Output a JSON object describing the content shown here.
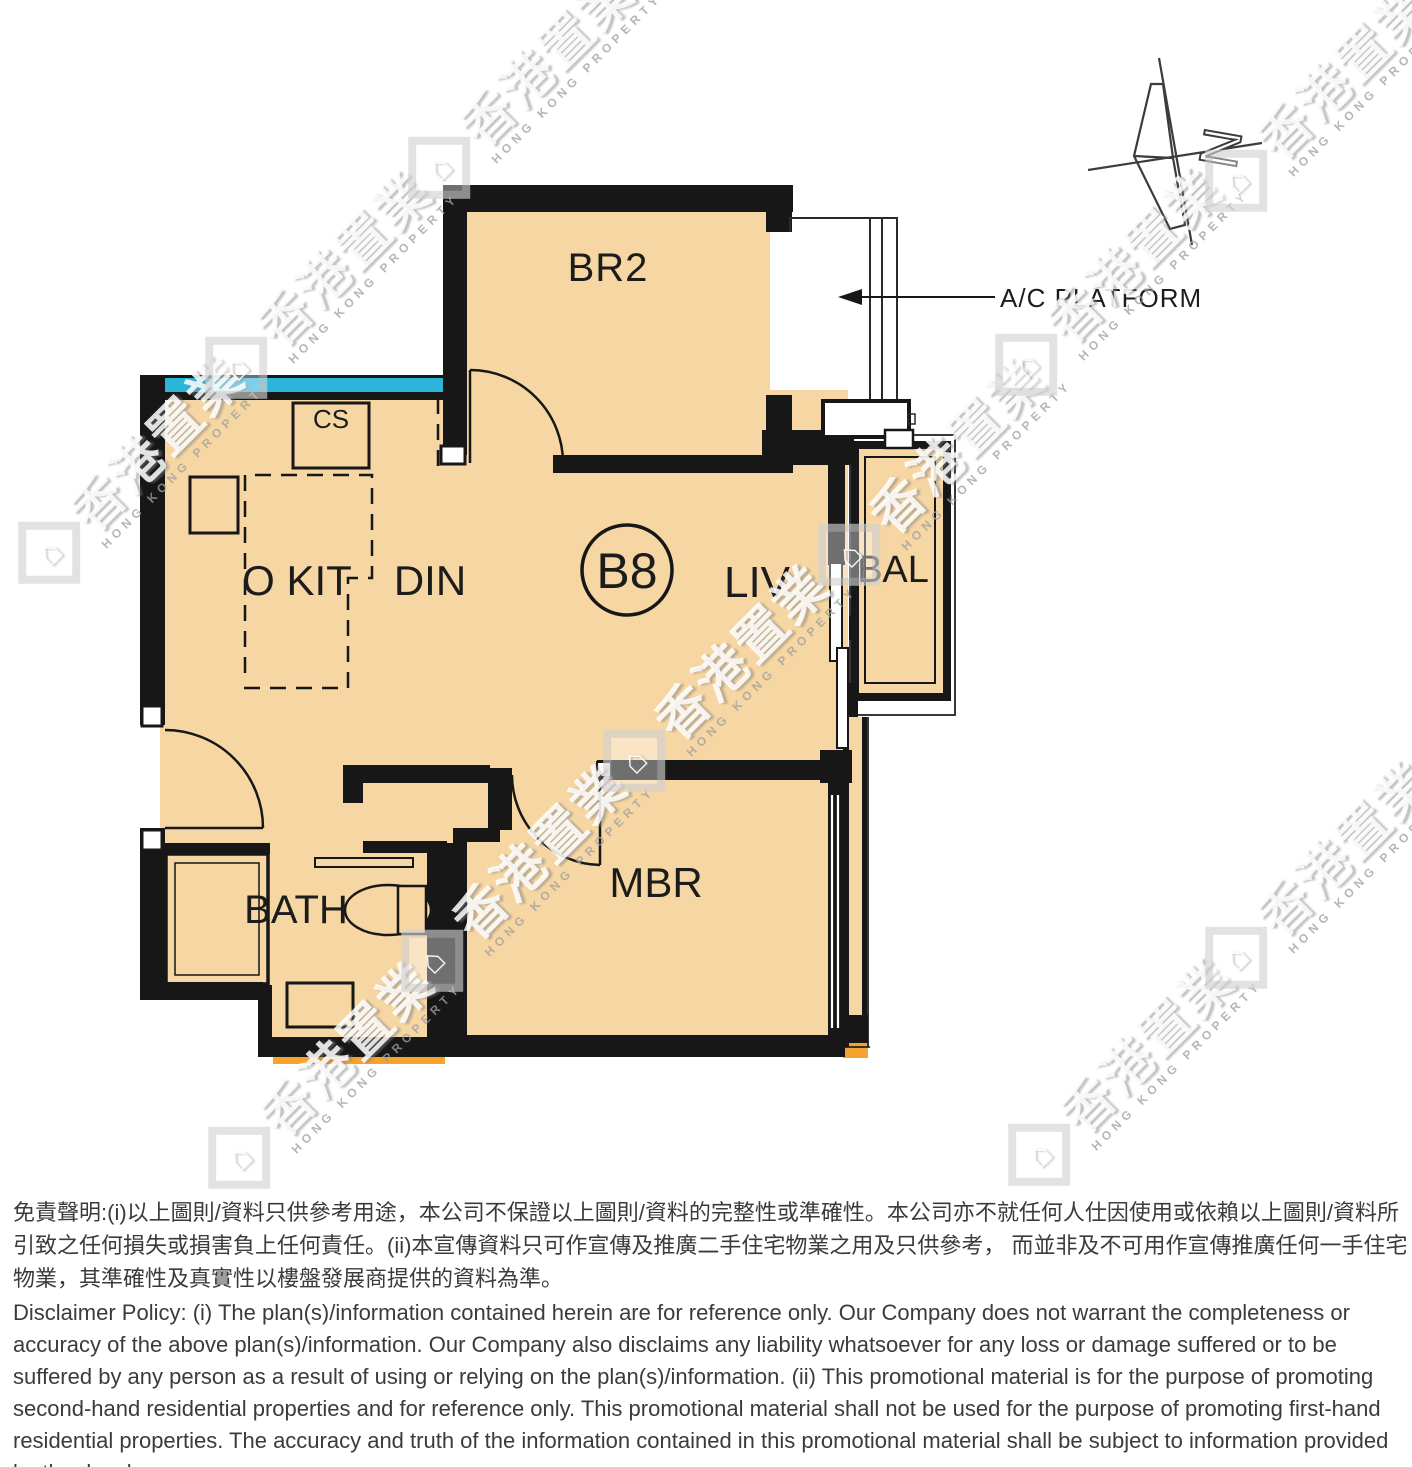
{
  "floorplan": {
    "unit_badge": "B8",
    "rooms": {
      "br2": "BR2",
      "okit": "O KIT",
      "din": "DIN",
      "liv": "LIV",
      "bal": "BAL",
      "mbr": "MBR",
      "bath": "BATH",
      "cs": "CS"
    },
    "annotations": {
      "ac_platform": "A/C PLATFORM",
      "compass_letter": "N"
    }
  },
  "watermark": {
    "chars": "香港置業",
    "subtext": "HONG KONG PROPERTY"
  },
  "disclaimer": {
    "chinese": "免責聲明:(i)以上圖則/資料只供參考用途，本公司不保證以上圖則/資料的完整性或準確性。本公司亦不就任何人仕因使用或依賴以上圖則/資料所引致之任何損失或損害負上任何責任。(ii)本宣傳資料只可作宣傳及推廣二手住宅物業之用及只供參考， 而並非及不可用作宣傳推廣任何一手住宅物業，其準確性及真實性以樓盤發展商提供的資料為準。",
    "english": "Disclaimer Policy: (i) The plan(s)/information contained herein are for reference only. Our Company does not warrant the completeness or accuracy of the above plan(s)/information. Our Company also disclaims any liability whatsoever for any loss or damage suffered or to be suffered by any person as a result of using or relying on the plan(s)/information. (ii) This promotional material is for the purpose of promoting second-hand residential properties and for reference only. This promotional material shall not be used for the purpose of promoting first-hand residential properties. The accuracy and truth of the information contained in this promotional material shall be subject to information provided by the developers."
  },
  "colors": {
    "room_fill": "#f6d6a2",
    "wall": "#171717",
    "window_accent": "#2cb5db",
    "highlight_orange": "#f5a32c"
  }
}
